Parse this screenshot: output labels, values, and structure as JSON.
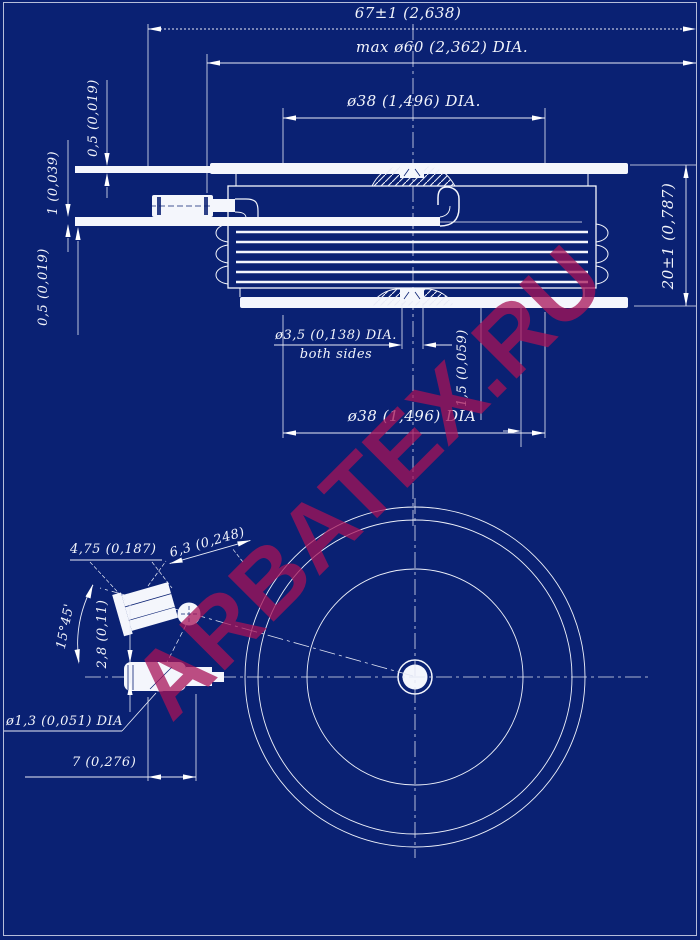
{
  "colors": {
    "background": "#0a2173",
    "line": "#ffffff",
    "watermark": "#a81358"
  },
  "watermark": {
    "text": "ARBATEX.RU"
  },
  "section_view": {
    "overall_width": "67±1 (2,638)",
    "max_diameter": "max ø60 (2,362) DIA.",
    "top_pole_diameter": "ø38 (1,496) DIA.",
    "top_lead_thickness": "0,5 (0,019)",
    "gate_lead_thickness": "1 (0,039)",
    "bottom_lead_thickness": "0,5 (0,019)",
    "body_height": "20±1 (0,787)",
    "gate_hole_diameter": "ø3,5 (0,138) DIA.",
    "gate_hole_note": "both sides",
    "recess_depth": "1,5 (0,059)",
    "bottom_pole_diameter": "ø38 (1,496) DIA"
  },
  "bottom_view": {
    "terminal_width": "4,75 (0,187)",
    "terminal_length": "6,3 (0,248)",
    "terminal_angle": "15°45'",
    "terminal_offset": "2,8 (0,11)",
    "terminal_hole_diameter": "ø1,3 (0,051) DIA",
    "terminal_span": "7 (0,276)"
  }
}
